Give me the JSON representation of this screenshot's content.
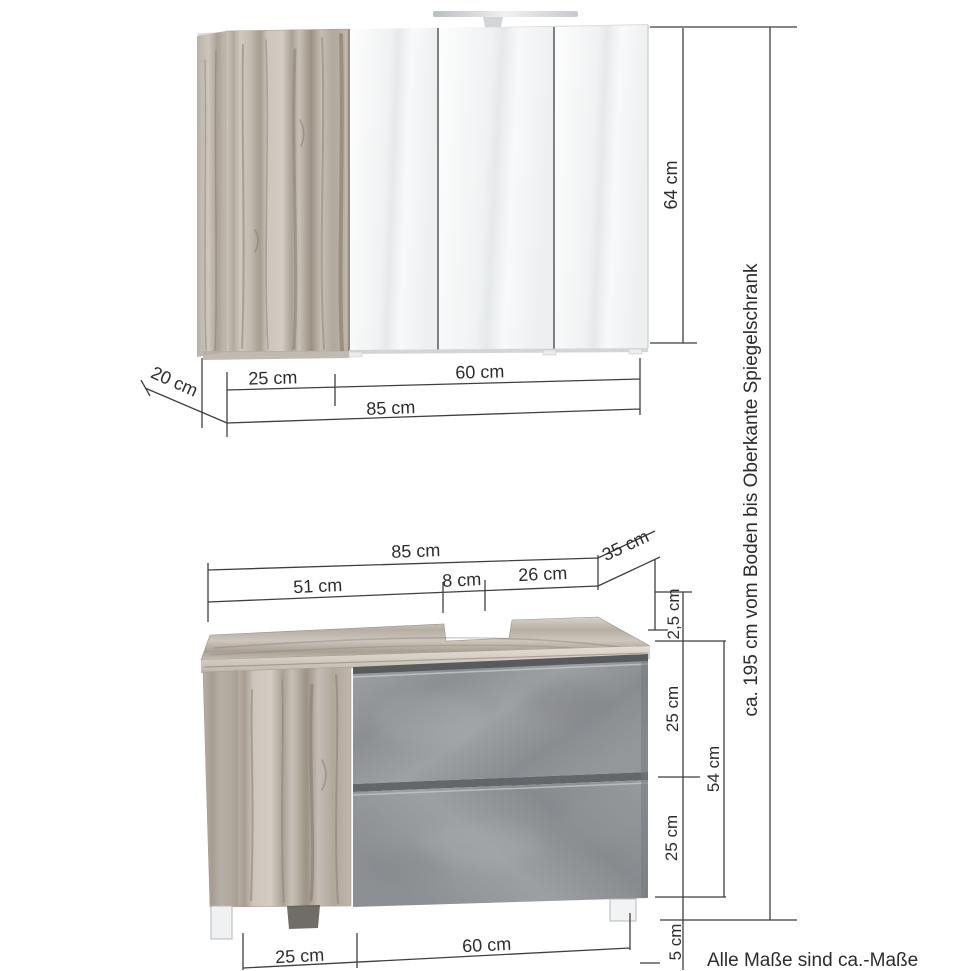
{
  "diagram": {
    "footnote": "Alle Maße sind ca.-Maße",
    "overall_height": "ca. 195 cm vom Boden bis Oberkante Spiegelschrank"
  },
  "mirror_cabinet": {
    "door_width": "25 cm",
    "mirror_section_width": "60 cm",
    "total_width": "85 cm",
    "depth": "20 cm",
    "height": "64 cm"
  },
  "vanity_cabinet": {
    "total_width": "85 cm",
    "left_section_width": "51 cm",
    "siphon_cutout_width": "8 cm",
    "right_section_width": "26 cm",
    "depth": "35 cm",
    "countertop_thickness": "2,5 cm",
    "upper_drawer_height": "25 cm",
    "lower_drawer_height": "25 cm",
    "front_height": "54 cm",
    "feet_height": "5 cm",
    "door_width": "25 cm",
    "drawer_section_width": "60 cm"
  }
}
